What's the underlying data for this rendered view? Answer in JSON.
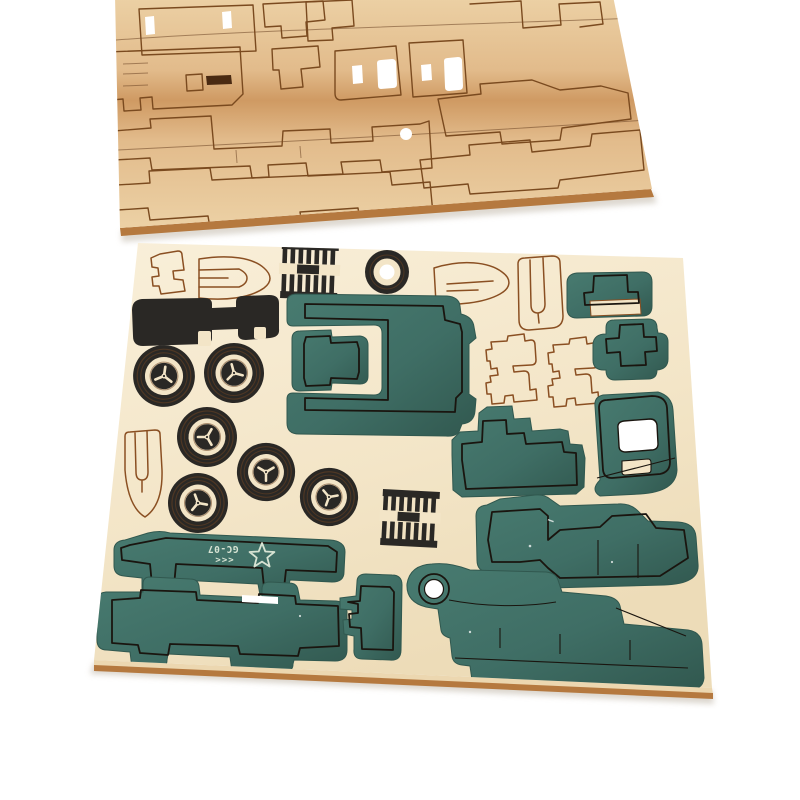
{
  "scene": {
    "type": "product-photo",
    "subject": "Two laser-cut plywood sheets of a wooden 3D puzzle military-truck model kit on a white background",
    "background": "#ffffff"
  },
  "markings": {
    "model_code": "GC-07",
    "chevrons": "<<<",
    "star_icon": "star-outline"
  },
  "top_sheet": {
    "description": "Unpainted natural plywood sheet, tilted, with laser-cut vehicle part outlines (chassis rails, cab sides, panels)"
  },
  "main_sheet": {
    "description": "Cream plywood sheet holding painted die-cut parts",
    "wheel_count": 6,
    "paint_colors": [
      "green",
      "black"
    ],
    "unpainted_outline_parts": 7
  },
  "colors": {
    "background": "#ffffff",
    "wood_light": "#ecd1a5",
    "wood_mid": "#e2bb8b",
    "wood_dark_band": "#cf9a63",
    "wood_cut_line": "#7a4a1f",
    "cream_light": "#f9efd9",
    "cream": "#f3e5c7",
    "cream_dark": "#eddcb8",
    "sheet_edge_light": "#ecd7b0",
    "sheet_edge_brown": "#b5793f",
    "sheet_edge_dark": "#7a4e24",
    "green_light": "#487b70",
    "green": "#3f6e65",
    "green_dark": "#31584f",
    "cut_dark": "#1a150f",
    "black_paint": "#2a2825",
    "etch_brown": "#6b4424",
    "outline_brown": "#8a4f22",
    "slot_dark": "#4a2a12",
    "marking_pale": "#d7e3d3",
    "shadow": "#d5cfc5",
    "hole_white": "#ffffff"
  }
}
